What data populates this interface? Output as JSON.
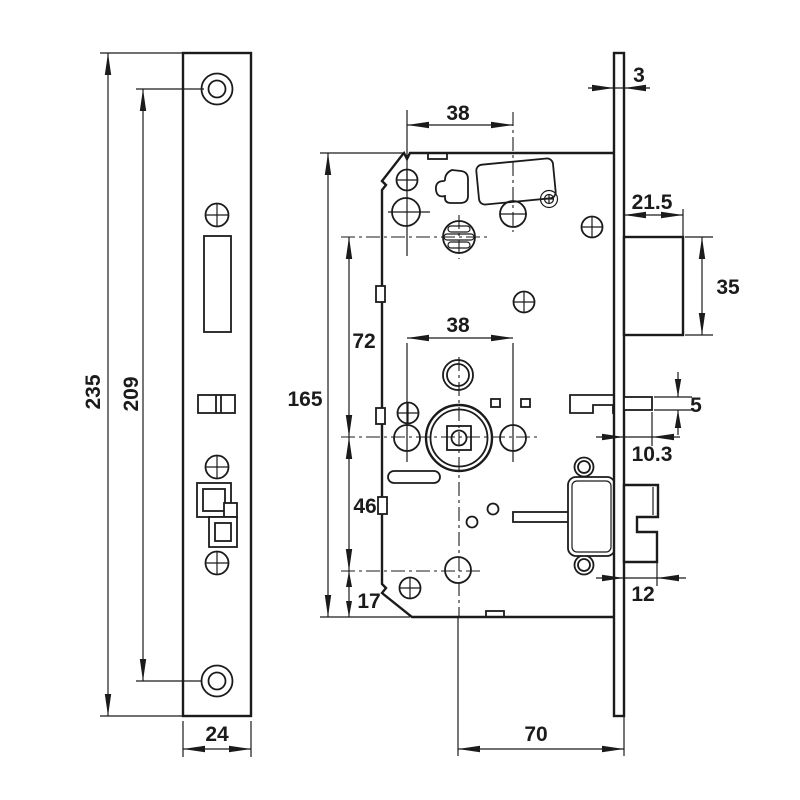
{
  "drawing": {
    "dimensions": {
      "faceplate_height": "235",
      "screw_hole_spacing": "209",
      "faceplate_width": "24",
      "case_top_hole_spacing": "38",
      "forend_thickness": "3",
      "latchbolt_projection": "21.5",
      "latchbolt_height": "35",
      "cylinder_to_spindle": "72",
      "case_height": "165",
      "spindle_hole_spacing": "38",
      "spindle_to_lower_hole": "46",
      "lower_hole_to_bottom": "17",
      "deadlatch_height": "5",
      "deadlatch_projection": "10.3",
      "deadbolt_projection": "12",
      "backset": "70"
    }
  }
}
